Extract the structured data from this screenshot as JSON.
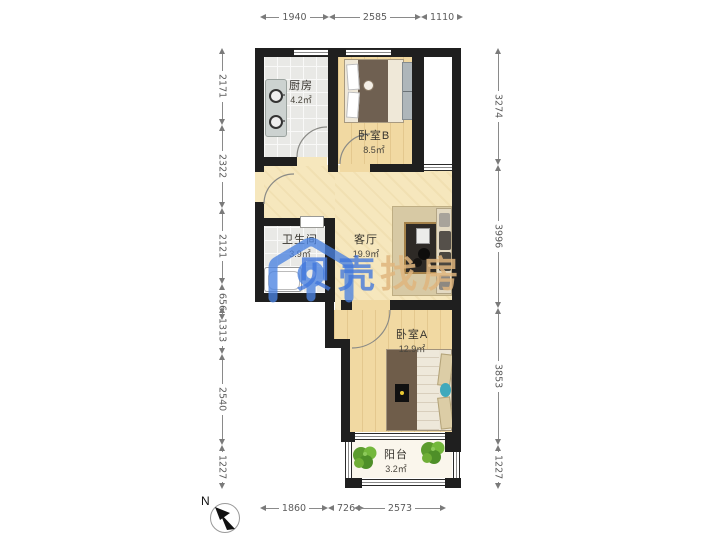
{
  "watermark": {
    "brand_blue": "贝壳",
    "brand_tan": "找房"
  },
  "compass": {
    "label": "N"
  },
  "rooms": {
    "kitchen": {
      "name": "厨房",
      "area": "4.2㎡"
    },
    "bedroom_b": {
      "name": "卧室B",
      "area": "8.5㎡"
    },
    "bathroom": {
      "name": "卫生间",
      "area": "3.9㎡"
    },
    "living": {
      "name": "客厅",
      "area": "19.9㎡"
    },
    "bedroom_a": {
      "name": "卧室A",
      "area": "12.9㎡"
    },
    "balcony": {
      "name": "阳台",
      "area": "3.2㎡"
    }
  },
  "dimensions": {
    "top": [
      "1940",
      "2585",
      "1110"
    ],
    "bottom": [
      "1860",
      "726",
      "2573"
    ],
    "left": [
      "2171",
      "2322",
      "2121",
      "656",
      "1313",
      "2540",
      "1227"
    ],
    "right": [
      "3274",
      "3996",
      "3853",
      "1227"
    ]
  }
}
